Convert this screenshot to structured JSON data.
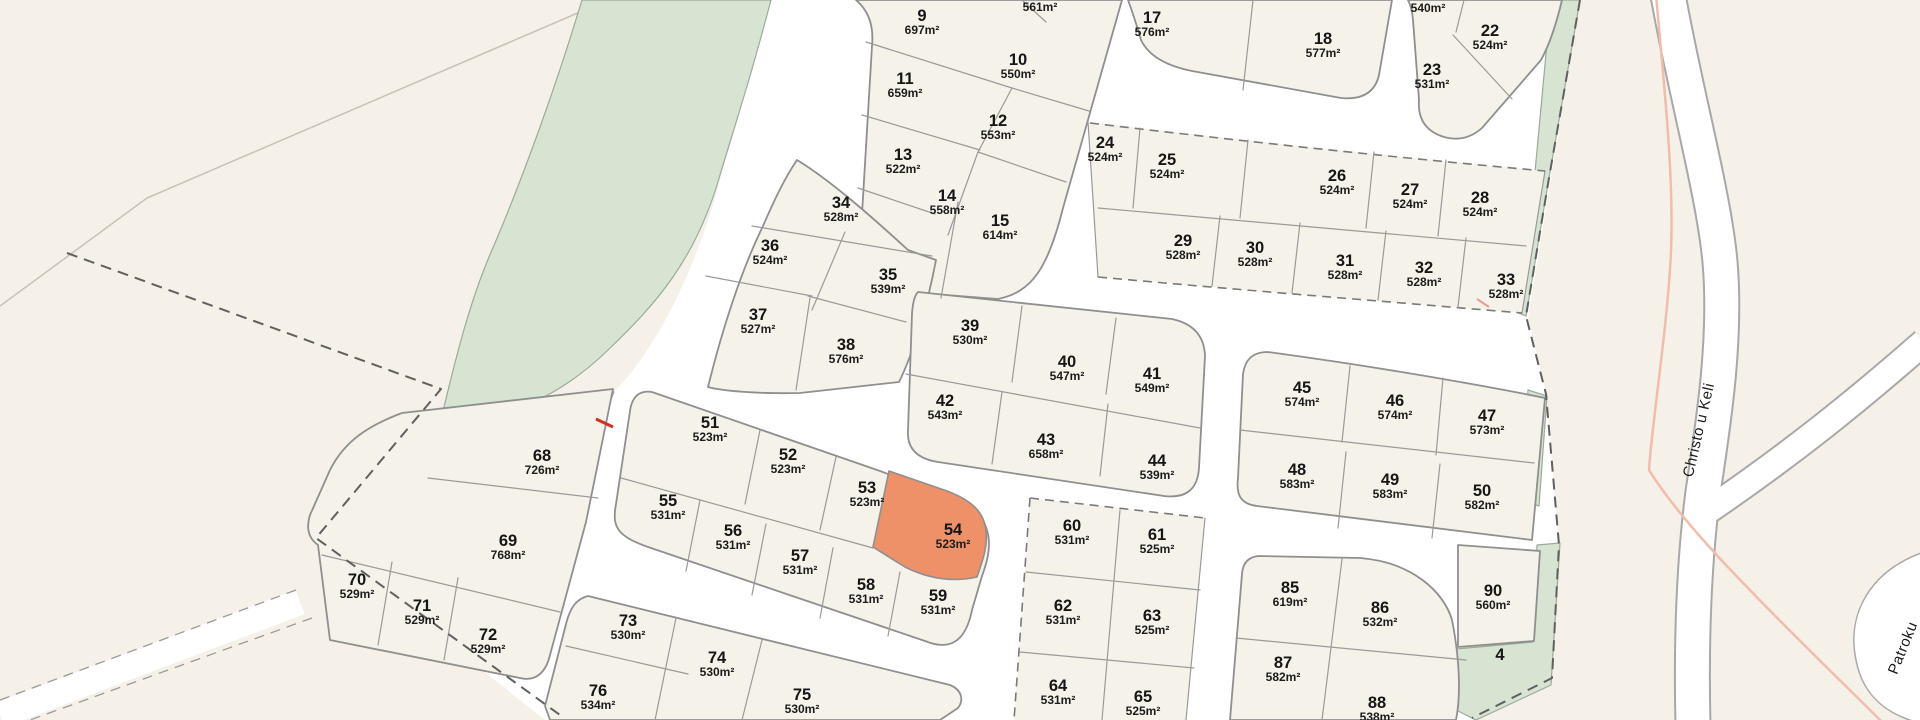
{
  "map": {
    "description": "Subdivision parcel map with numbered lots and areas",
    "colors": {
      "background": "#f5f1e8",
      "road": "#ffffff",
      "parcel_fill": "#f5f2ea",
      "green_area": "#d6e4d1",
      "highlight_parcel": "#ef9168",
      "outline": "#8f8f8f",
      "text": "#1a1a1a"
    },
    "highlighted_parcel": {
      "number": "54",
      "area": "523m²"
    },
    "parcels": [
      {
        "n": "9",
        "a": "697m²",
        "x": 922,
        "y": 16
      },
      {
        "n": "10",
        "a": "550m²",
        "x": 1018,
        "y": 60
      },
      {
        "n": "11",
        "a": "659m²",
        "x": 905,
        "y": 79
      },
      {
        "n": "12",
        "a": "553m²",
        "x": 998,
        "y": 121
      },
      {
        "n": "13",
        "a": "522m²",
        "x": 903,
        "y": 155
      },
      {
        "n": "14",
        "a": "558m²",
        "x": 947,
        "y": 196
      },
      {
        "n": "15",
        "a": "614m²",
        "x": 1000,
        "y": 221
      },
      {
        "n": "17",
        "a": "576m²",
        "x": 1152,
        "y": 18
      },
      {
        "n": "18",
        "a": "577m²",
        "x": 1323,
        "y": 39
      },
      {
        "n": "22",
        "a": "524m²",
        "x": 1490,
        "y": 31
      },
      {
        "n": "23",
        "a": "531m²",
        "x": 1432,
        "y": 70
      },
      {
        "n": "24",
        "a": "524m²",
        "x": 1105,
        "y": 143
      },
      {
        "n": "25",
        "a": "524m²",
        "x": 1167,
        "y": 160
      },
      {
        "n": "26",
        "a": "524m²",
        "x": 1337,
        "y": 176
      },
      {
        "n": "27",
        "a": "524m²",
        "x": 1410,
        "y": 190
      },
      {
        "n": "28",
        "a": "524m²",
        "x": 1480,
        "y": 198
      },
      {
        "n": "29",
        "a": "528m²",
        "x": 1183,
        "y": 241
      },
      {
        "n": "30",
        "a": "528m²",
        "x": 1255,
        "y": 248
      },
      {
        "n": "31",
        "a": "528m²",
        "x": 1345,
        "y": 261
      },
      {
        "n": "32",
        "a": "528m²",
        "x": 1424,
        "y": 268
      },
      {
        "n": "33",
        "a": "528m²",
        "x": 1506,
        "y": 280
      },
      {
        "n": "34",
        "a": "528m²",
        "x": 841,
        "y": 203
      },
      {
        "n": "35",
        "a": "539m²",
        "x": 888,
        "y": 275
      },
      {
        "n": "36",
        "a": "524m²",
        "x": 770,
        "y": 246
      },
      {
        "n": "37",
        "a": "527m²",
        "x": 758,
        "y": 315
      },
      {
        "n": "38",
        "a": "576m²",
        "x": 846,
        "y": 345
      },
      {
        "n": "39",
        "a": "530m²",
        "x": 970,
        "y": 326
      },
      {
        "n": "40",
        "a": "547m²",
        "x": 1067,
        "y": 362
      },
      {
        "n": "41",
        "a": "549m²",
        "x": 1152,
        "y": 374
      },
      {
        "n": "42",
        "a": "543m²",
        "x": 945,
        "y": 401
      },
      {
        "n": "43",
        "a": "658m²",
        "x": 1046,
        "y": 440
      },
      {
        "n": "44",
        "a": "539m²",
        "x": 1157,
        "y": 461
      },
      {
        "n": "45",
        "a": "574m²",
        "x": 1302,
        "y": 388
      },
      {
        "n": "46",
        "a": "574m²",
        "x": 1395,
        "y": 401
      },
      {
        "n": "47",
        "a": "573m²",
        "x": 1487,
        "y": 416
      },
      {
        "n": "48",
        "a": "583m²",
        "x": 1297,
        "y": 470
      },
      {
        "n": "49",
        "a": "583m²",
        "x": 1390,
        "y": 480
      },
      {
        "n": "50",
        "a": "582m²",
        "x": 1482,
        "y": 491
      },
      {
        "n": "51",
        "a": "523m²",
        "x": 710,
        "y": 423
      },
      {
        "n": "52",
        "a": "523m²",
        "x": 788,
        "y": 455
      },
      {
        "n": "53",
        "a": "523m²",
        "x": 867,
        "y": 488
      },
      {
        "n": "54",
        "a": "523m²",
        "x": 953,
        "y": 530,
        "hl": true
      },
      {
        "n": "55",
        "a": "531m²",
        "x": 668,
        "y": 501
      },
      {
        "n": "56",
        "a": "531m²",
        "x": 733,
        "y": 531
      },
      {
        "n": "57",
        "a": "531m²",
        "x": 800,
        "y": 556
      },
      {
        "n": "58",
        "a": "531m²",
        "x": 866,
        "y": 585
      },
      {
        "n": "59",
        "a": "531m²",
        "x": 938,
        "y": 596
      },
      {
        "n": "60",
        "a": "531m²",
        "x": 1072,
        "y": 526
      },
      {
        "n": "61",
        "a": "525m²",
        "x": 1157,
        "y": 535
      },
      {
        "n": "62",
        "a": "531m²",
        "x": 1063,
        "y": 606
      },
      {
        "n": "63",
        "a": "525m²",
        "x": 1152,
        "y": 616
      },
      {
        "n": "64",
        "a": "531m²",
        "x": 1058,
        "y": 686
      },
      {
        "n": "65",
        "a": "525m²",
        "x": 1143,
        "y": 697
      },
      {
        "n": "68",
        "a": "726m²",
        "x": 542,
        "y": 456
      },
      {
        "n": "69",
        "a": "768m²",
        "x": 508,
        "y": 541
      },
      {
        "n": "70",
        "a": "529m²",
        "x": 357,
        "y": 580
      },
      {
        "n": "71",
        "a": "529m²",
        "x": 422,
        "y": 606
      },
      {
        "n": "72",
        "a": "529m²",
        "x": 488,
        "y": 635
      },
      {
        "n": "73",
        "a": "530m²",
        "x": 628,
        "y": 621
      },
      {
        "n": "74",
        "a": "530m²",
        "x": 717,
        "y": 658
      },
      {
        "n": "75",
        "a": "530m²",
        "x": 802,
        "y": 695
      },
      {
        "n": "76",
        "a": "534m²",
        "x": 598,
        "y": 691
      },
      {
        "n": "85",
        "a": "619m²",
        "x": 1290,
        "y": 588
      },
      {
        "n": "86",
        "a": "532m²",
        "x": 1380,
        "y": 608
      },
      {
        "n": "87",
        "a": "582m²",
        "x": 1283,
        "y": 663
      },
      {
        "n": "88",
        "a": "538m²",
        "x": 1377,
        "y": 703
      },
      {
        "n": "90",
        "a": "560m²",
        "x": 1493,
        "y": 591
      },
      {
        "n": "4",
        "a": "",
        "x": 1500,
        "y": 655
      }
    ],
    "partial_area_labels": [
      {
        "text": "561m²",
        "x": 1040,
        "y": 7
      },
      {
        "text": "540m²",
        "x": 1428,
        "y": 8
      }
    ],
    "road_labels": [
      {
        "text": "Christo u Keli",
        "x": 1699,
        "y": 430,
        "angle": -77
      },
      {
        "text": "Patroku",
        "x": 1903,
        "y": 648,
        "angle": -68
      }
    ]
  }
}
